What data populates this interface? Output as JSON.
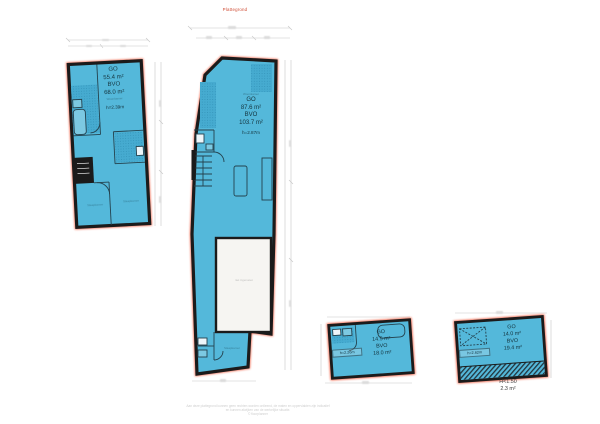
{
  "header": {
    "red_title": "Plattegrond"
  },
  "floorplans": {
    "plan1": {
      "go_label": "GO",
      "go_value": "55.4 m²",
      "bvo_label": "BVO",
      "bvo_value": "68.0 m²",
      "room_note": "Woonkamer",
      "height_note": "h=2.39m",
      "room_left": "Slaapkamer",
      "room_right": "Slaapkamer"
    },
    "plan2": {
      "room_note": "Woonkamer",
      "go_label": "GO",
      "go_value": "87.6 m²",
      "bvo_label": "BVO",
      "bvo_value": "103.7 m²",
      "height_note": "h=2.87m",
      "white_room_note": "niet ingemeten",
      "bottom_room": "Slaapkamer"
    },
    "plan3": {
      "go_label": "GO",
      "go_value": "14.5 m²",
      "bvo_label": "BVO",
      "bvo_value": "18.0 m²",
      "height_note": "h=2.26m"
    },
    "plan4": {
      "go_label": "GO",
      "go_value": "14.0 m²",
      "bvo_label": "BVO",
      "bvo_value": "19.4 m²",
      "height_note": "h=2.62m",
      "low_height_label": "H<1.50",
      "low_height_value": "2.3 m²"
    }
  },
  "footer": {
    "disclaimer_line1": "Aan deze plattegrond kunnen geen rechten worden ontleend, de maten en oppervlakten zijn indicatief",
    "disclaimer_line2": "en kunnen afwijken van de werkelijke situatie.",
    "disclaimer_line3": "© floorplanner"
  },
  "colors": {
    "fill": "#54b8da",
    "wall": "#1b1b1b",
    "outline": "#f04a2a"
  }
}
